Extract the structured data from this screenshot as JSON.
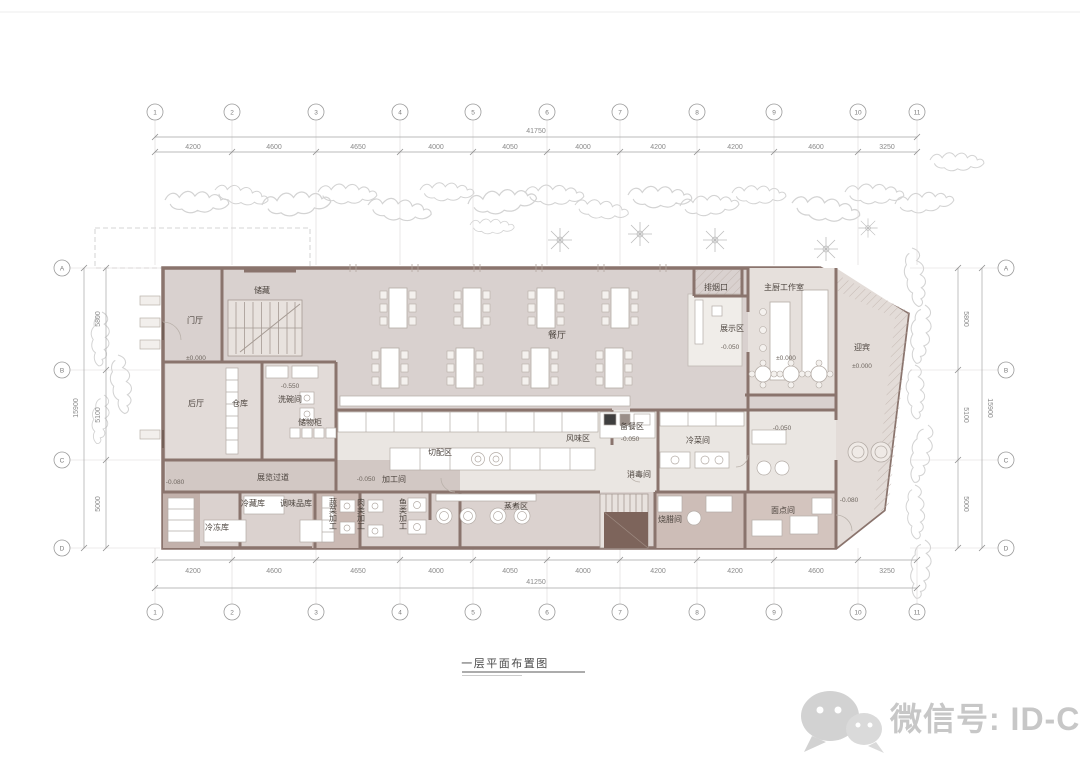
{
  "sheet": {
    "title": "一层平面布置图",
    "watermark_text": "微信号: ID-China"
  },
  "grid": {
    "top_total": "41750",
    "bottom_total": "41250",
    "side_total": "15900",
    "h_segments": [
      "4200",
      "4600",
      "4650",
      "4000",
      "4050",
      "4000",
      "4200",
      "4200",
      "4600",
      "3250"
    ],
    "v_segments": [
      "5800",
      "5100",
      "5000"
    ],
    "h_bubbles": [
      "1",
      "2",
      "3",
      "4",
      "5",
      "6",
      "7",
      "8",
      "9",
      "10",
      "11"
    ],
    "v_bubbles": [
      "A",
      "B",
      "C",
      "D"
    ]
  },
  "rooms": {
    "storage": "储藏",
    "foyer": "门厅",
    "backHall": "后厅",
    "warehouse": "仓库",
    "dishwash": "洗碗间",
    "lockers": "储物柜",
    "dining": "餐厅",
    "display": "展示区",
    "exhaust": "排烟口",
    "chefStudio": "主厨工作室",
    "welcome": "迎宾",
    "cutting": "切配区",
    "flavor": "风味区",
    "prep": "备餐区",
    "processing": "加工间",
    "disinfect": "消毒间",
    "coldDish": "冷菜间",
    "corridor": "展览过道",
    "coldStore": "冷藏库",
    "freezer": "冷冻库",
    "condiment": "调味品库",
    "veg": "蔬菜加工",
    "meat": "肉类加工",
    "fish": "鱼类加工",
    "steam": "蒸煮区",
    "roast": "烧腊间",
    "pastry": "面点间"
  },
  "elev": {
    "zero": "±0.000",
    "m050": "-0.050",
    "m080": "-0.080",
    "m550": "-0.550"
  }
}
